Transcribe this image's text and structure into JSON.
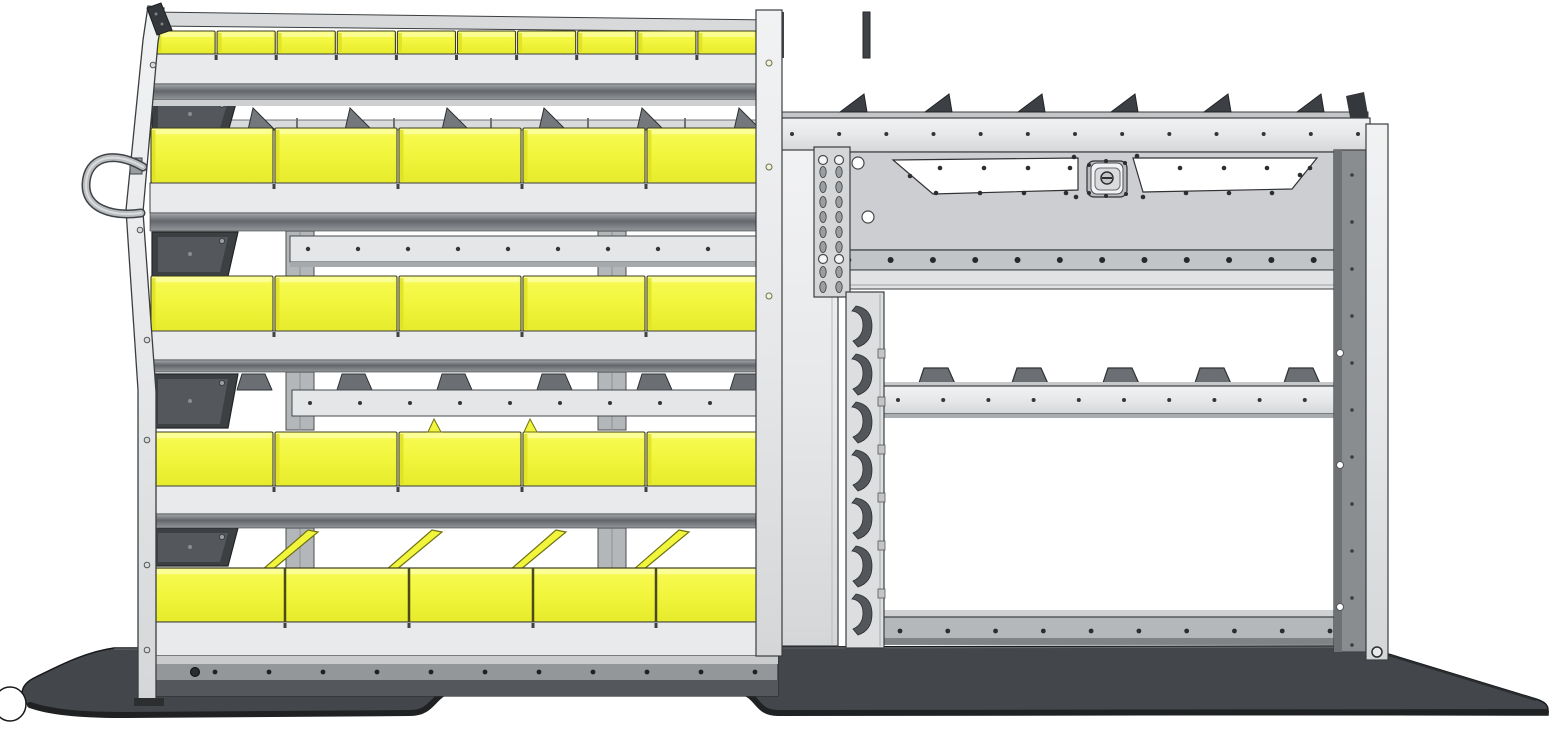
{
  "scene": {
    "description": "CAD side-view rendering of a van shelving package: left bin shelving unit with yellow plastic bins, right shelving unit with fold-down locking door panel, louvered hook panel, and contoured van floor plate",
    "background": "#ffffff",
    "colors": {
      "bin_yellow": "#f1f53c",
      "bin_yellow_light": "#fbfe9c",
      "bin_yellow_dark": "#dde122",
      "bin_outline": "#3c3d20",
      "metal_light": "#e9eaec",
      "metal_mid": "#c7cacc",
      "metal_dark": "#9da0a3",
      "outline": "#3b3e40",
      "bracket_dark": "#3c4043",
      "divider_gray": "#6b6f73",
      "floor_top": "#43464a",
      "floor_edge": "#1f2123",
      "rear_post": "#8a8d90",
      "white": "#ffffff"
    },
    "left_unit": {
      "name": "left-bin-shelving-unit",
      "rows": [
        {
          "type": "small-bins",
          "bin_count": 10
        },
        {
          "type": "large-bins",
          "bin_count": 5
        },
        {
          "type": "large-bins",
          "bin_count": 5
        },
        {
          "type": "large-bins",
          "bin_count": 5
        },
        {
          "type": "divided-tray",
          "divider_count": 4
        }
      ],
      "shelf_count": 5,
      "divider_fin_count": 6,
      "shelf_tab_count": 6,
      "corner_bracket_count": 4,
      "upright_rivet_count": 6,
      "base_rivet_count": 11
    },
    "right_unit": {
      "name": "right-shelf-unit-with-door-kit",
      "door_panel": {
        "handle_cutouts": 2,
        "latch": true,
        "corner_hole_count": 6,
        "rivet_rail_rivet_count": 14
      },
      "top_rail_gusset_count": 6,
      "top_rail_rivet_count": 13,
      "slotted_track_slot_count": 8,
      "louver_hook_count": 7,
      "mid_shelf_tab_count": 5,
      "mid_shelf_rivet_count": 11,
      "bottom_rail_rivet_count": 10,
      "rear_post_hole_count": 11
    },
    "floor": {
      "name": "van-floor-plate",
      "wheel_notch": true
    },
    "accessories": {
      "hose_hook": true
    }
  }
}
